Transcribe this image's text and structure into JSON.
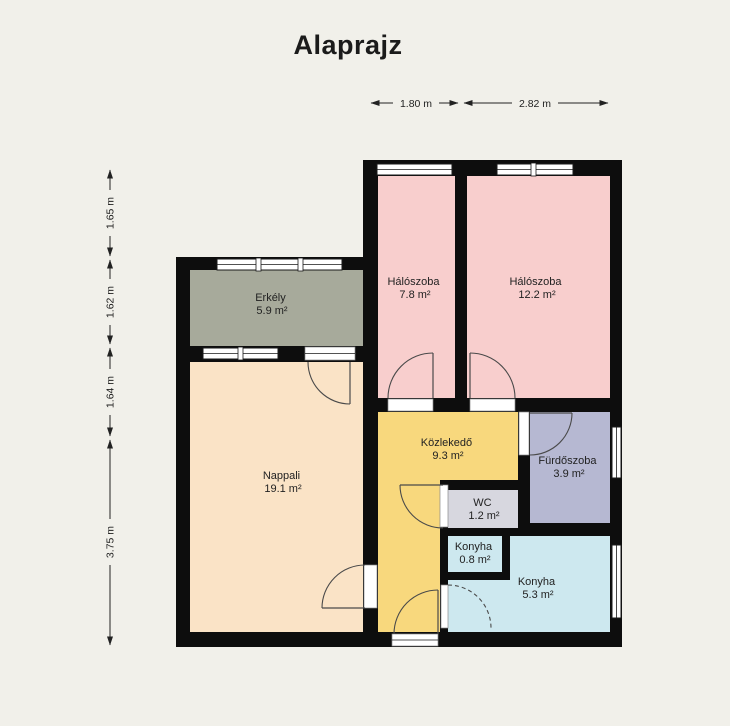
{
  "title": "Alaprajz",
  "dimensions": {
    "top": [
      {
        "label": "1.80 m"
      },
      {
        "label": "2.82 m"
      }
    ],
    "left": [
      {
        "label": "1.65 m"
      },
      {
        "label": "1.62 m"
      },
      {
        "label": "1.64 m"
      },
      {
        "label": "3.75 m"
      }
    ]
  },
  "rooms": [
    {
      "name": "Erkély",
      "area": "5.9 m²",
      "color": "#a7aa9b"
    },
    {
      "name": "Hálószoba",
      "area": "7.8 m²",
      "color": "#f8cecd"
    },
    {
      "name": "Hálószoba",
      "area": "12.2 m²",
      "color": "#f8cecd"
    },
    {
      "name": "Nappali",
      "area": "19.1 m²",
      "color": "#fae3c6"
    },
    {
      "name": "Közlekedő",
      "area": "9.3 m²",
      "color": "#f8d87d"
    },
    {
      "name": "Fürdőszoba",
      "area": "3.9 m²",
      "color": "#b6b8d2"
    },
    {
      "name": "WC",
      "area": "1.2 m²",
      "color": "#d7d7df"
    },
    {
      "name": "Konyha",
      "area": "0.8 m²",
      "color": "#cde8ef"
    },
    {
      "name": "Konyha",
      "area": "5.3 m²",
      "color": "#cde8ef"
    }
  ],
  "colors": {
    "background": "#f1f0ea",
    "wall": "#0d0d0d"
  }
}
